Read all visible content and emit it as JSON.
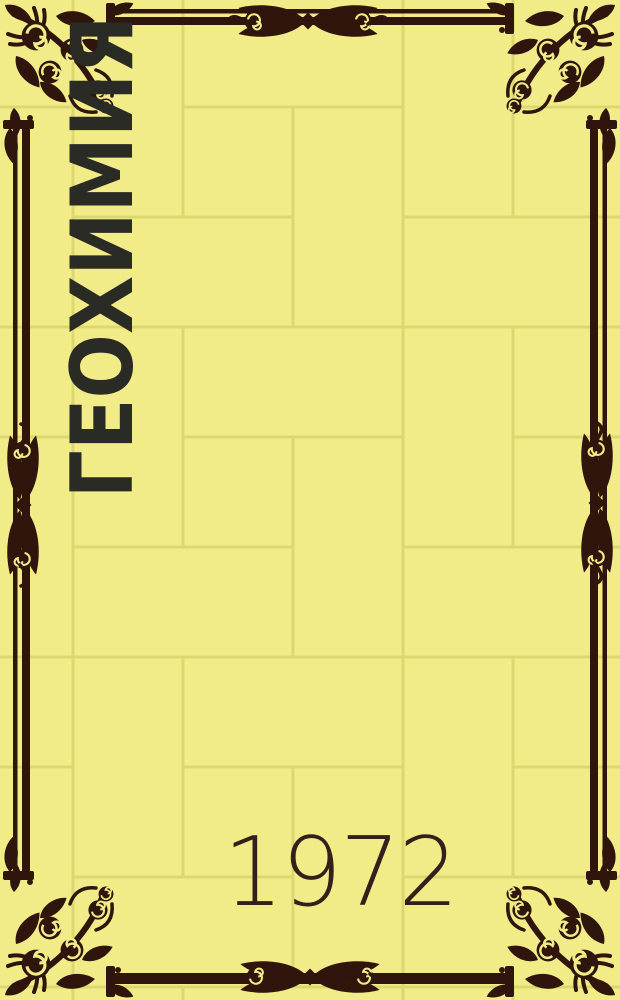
{
  "cover": {
    "title": "ГЕОХИМИЯ",
    "year": "1972",
    "colors": {
      "background": "#f1ec88",
      "grout": "#ddd76f",
      "frame": "#2f150c",
      "title_text": "#2b2b25",
      "year_text": "#33201a"
    }
  }
}
